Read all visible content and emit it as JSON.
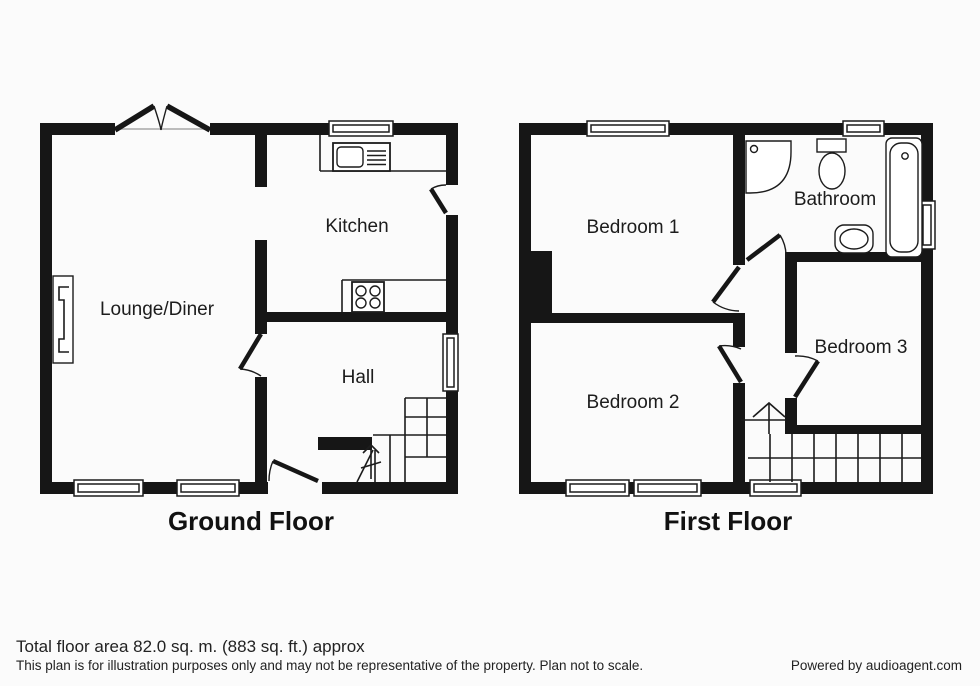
{
  "page": {
    "type": "estate-agent-floorplan",
    "colors": {
      "ink": "#161616",
      "background": "#fbfbfb",
      "window_line": "#a8a8a8"
    }
  },
  "floors": [
    {
      "title": "Ground Floor",
      "rooms": [
        {
          "name": "lounge-diner",
          "label": "Lounge/Diner"
        },
        {
          "name": "kitchen",
          "label": "Kitchen"
        },
        {
          "name": "hall",
          "label": "Hall"
        }
      ]
    },
    {
      "title": "First Floor",
      "rooms": [
        {
          "name": "bedroom-1",
          "label": "Bedroom 1"
        },
        {
          "name": "bathroom",
          "label": "Bathroom"
        },
        {
          "name": "bedroom-2",
          "label": "Bedroom 2"
        },
        {
          "name": "bedroom-3",
          "label": "Bedroom 3"
        }
      ]
    }
  ],
  "symbols": [
    "window-symbol",
    "door-symbol",
    "french-doors-symbol",
    "stairs-symbol",
    "stair-direction-arrow",
    "kitchen-sink-symbol",
    "hob-symbol",
    "fireplace-symbol",
    "chimney-breast-symbol",
    "shower-symbol",
    "toilet-symbol",
    "bath-symbol",
    "basin-symbol"
  ],
  "footer": {
    "area_text": "Total floor area 82.0 sq. m. (883 sq. ft.) approx",
    "disclaimer": "This plan is for illustration purposes only and may not be representative of the property. Plan not to scale.",
    "credit": "Powered by audioagent.com"
  }
}
